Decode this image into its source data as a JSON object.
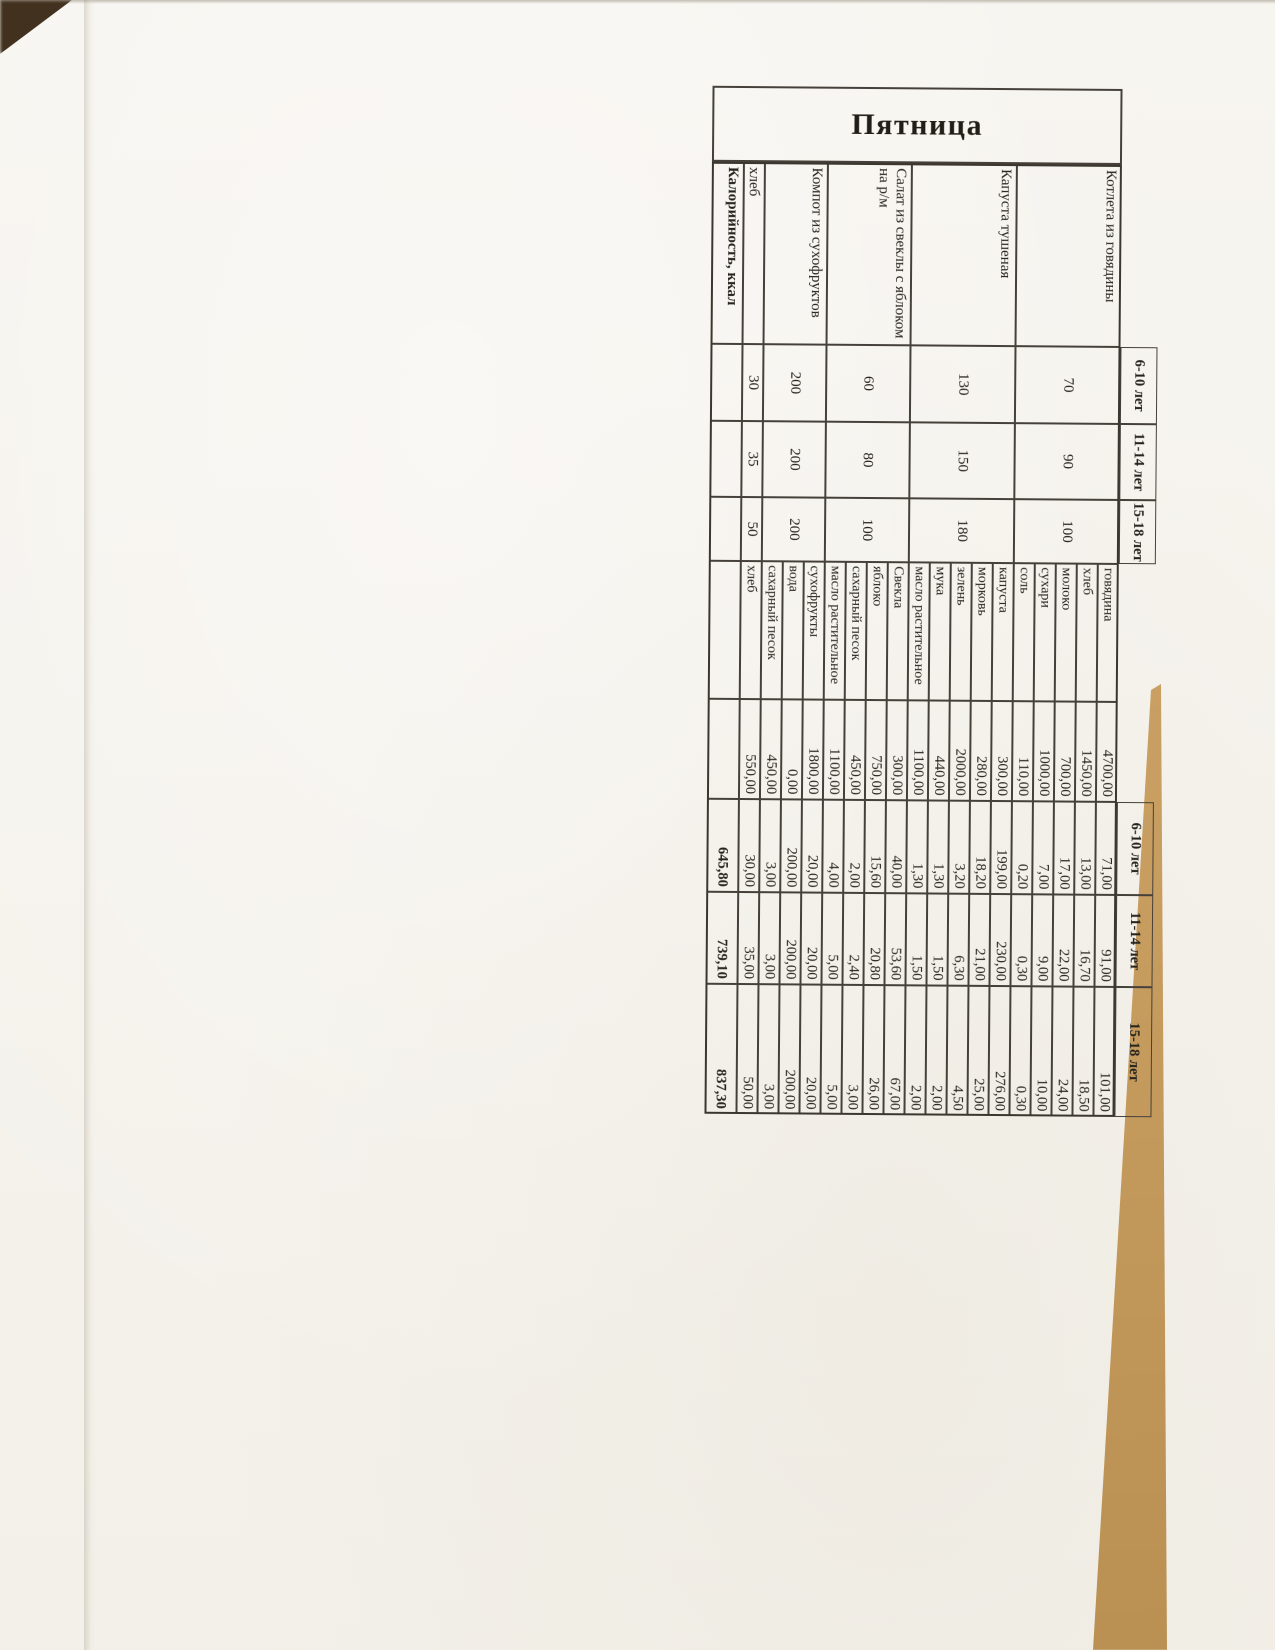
{
  "title": "Пятница",
  "age_headers": [
    "6-10 лет",
    "11-14 лет",
    "15-18 лет"
  ],
  "table": {
    "dishes": [
      {
        "name": "Котлета из говядины",
        "portions": [
          "70",
          "90",
          "100"
        ],
        "ingredients": [
          {
            "name": "говядина",
            "gross": "4700,00",
            "amounts": [
              "71,00",
              "91,00",
              "101,00"
            ]
          },
          {
            "name": "хлеб",
            "gross": "1450,00",
            "amounts": [
              "13,00",
              "16,70",
              "18,50"
            ]
          },
          {
            "name": "молоко",
            "gross": "700,00",
            "amounts": [
              "17,00",
              "22,00",
              "24,00"
            ]
          },
          {
            "name": "сухари",
            "gross": "1000,00",
            "amounts": [
              "7,00",
              "9,00",
              "10,00"
            ]
          },
          {
            "name": "соль",
            "gross": "110,00",
            "amounts": [
              "0,20",
              "0,30",
              "0,30"
            ]
          }
        ]
      },
      {
        "name": "Капуста тушеная",
        "portions": [
          "130",
          "150",
          "180"
        ],
        "ingredients": [
          {
            "name": "капуста",
            "gross": "300,00",
            "amounts": [
              "199,00",
              "230,00",
              "276,00"
            ]
          },
          {
            "name": "морковь",
            "gross": "280,00",
            "amounts": [
              "18,20",
              "21,00",
              "25,00"
            ]
          },
          {
            "name": "зелень",
            "gross": "2000,00",
            "amounts": [
              "3,20",
              "6,30",
              "4,50"
            ]
          },
          {
            "name": "мука",
            "gross": "440,00",
            "amounts": [
              "1,30",
              "1,50",
              "2,00"
            ]
          },
          {
            "name": "масло растительное",
            "gross": "1100,00",
            "amounts": [
              "1,30",
              "1,50",
              "2,00"
            ]
          }
        ]
      },
      {
        "name": "Салат из свеклы с яблоком на р/м",
        "portions": [
          "60",
          "80",
          "100"
        ],
        "ingredients": [
          {
            "name": "Свекла",
            "gross": "300,00",
            "amounts": [
              "40,00",
              "53,60",
              "67,00"
            ]
          },
          {
            "name": "яблоко",
            "gross": "750,00",
            "amounts": [
              "15,60",
              "20,80",
              "26,00"
            ]
          },
          {
            "name": "сахарный песок",
            "gross": "450,00",
            "amounts": [
              "2,00",
              "2,40",
              "3,00"
            ]
          },
          {
            "name": "масло растительное",
            "gross": "1100,00",
            "amounts": [
              "4,00",
              "5,00",
              "5,00"
            ]
          }
        ]
      },
      {
        "name": "Компот из сухофруктов",
        "portions": [
          "200",
          "200",
          "200"
        ],
        "ingredients": [
          {
            "name": "сухофрукты",
            "gross": "1800,00",
            "amounts": [
              "20,00",
              "20,00",
              "20,00"
            ]
          },
          {
            "name": "вода",
            "gross": "0,00",
            "amounts": [
              "200,00",
              "200,00",
              "200,00"
            ]
          },
          {
            "name": "сахарный песок",
            "gross": "450,00",
            "amounts": [
              "3,00",
              "3,00",
              "3,00"
            ]
          }
        ]
      },
      {
        "name": "хлеб",
        "portions": [
          "30",
          "35",
          "50"
        ],
        "ingredients": [
          {
            "name": "хлеб",
            "gross": "550,00",
            "amounts": [
              "30,00",
              "35,00",
              "50,00"
            ]
          }
        ]
      }
    ],
    "calories_row": {
      "label": "Калорийность, ккал",
      "values": [
        "645,80",
        "739,10",
        "837,30"
      ]
    }
  }
}
